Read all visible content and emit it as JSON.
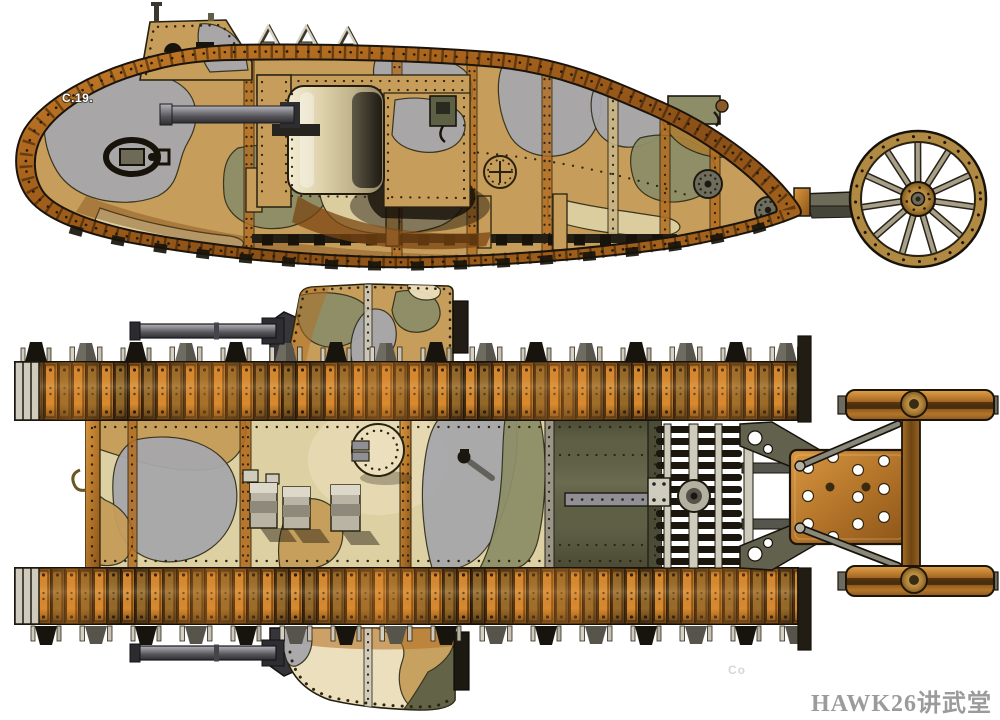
{
  "illustration": {
    "background": "#ffffff",
    "side_view": {
      "marking": "C.19."
    },
    "watermark": {
      "text": "HAWK26讲武堂"
    },
    "corner_text": {
      "text": "Co"
    },
    "palette": {
      "paper": "#ffffff",
      "tan": "#c69d5a",
      "ochre": "#a87f38",
      "cream": "#ddd0a2",
      "sand": "#ecdfbd",
      "grey": "#a7a7ab",
      "olive": "#8d8e68",
      "dk_olive": "#5e6046",
      "rust": "#b26d20",
      "rust_dark": "#7a4512",
      "rust_bright": "#d88a2e",
      "brown": "#5c4423",
      "steel": "#cfcbbd",
      "metal": "#8f8f95",
      "ink": "#1b170f",
      "wood": "#b08a42",
      "marking": "#ffffff",
      "watermark_grey": "#9b9b9b",
      "faint_grey": "#d6d6d6"
    }
  }
}
